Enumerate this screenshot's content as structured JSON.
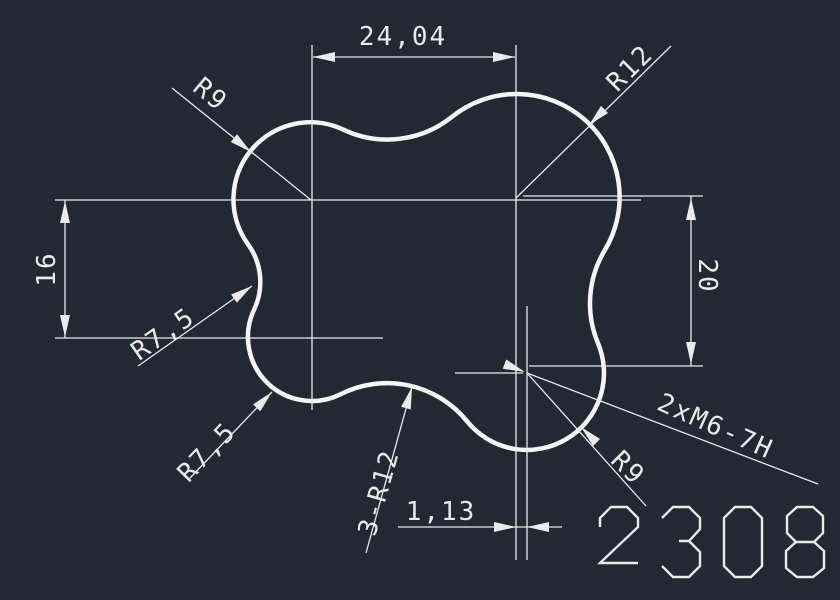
{
  "drawing": {
    "part_number": "2308",
    "dims": {
      "width": "24,04",
      "height_left": "16",
      "height_right": "20",
      "offset": "1,13"
    },
    "radii": {
      "top_left": "R9",
      "top_right": "R12",
      "left": "R7,5",
      "bottom_left": "R7,5",
      "bottom": "3-R12",
      "bottom_right": "R9"
    },
    "thread_callout": "2xM6-7H",
    "colors": {
      "background": "#232932",
      "line": "#e8eaec",
      "outline": "#f4f5f6"
    }
  }
}
